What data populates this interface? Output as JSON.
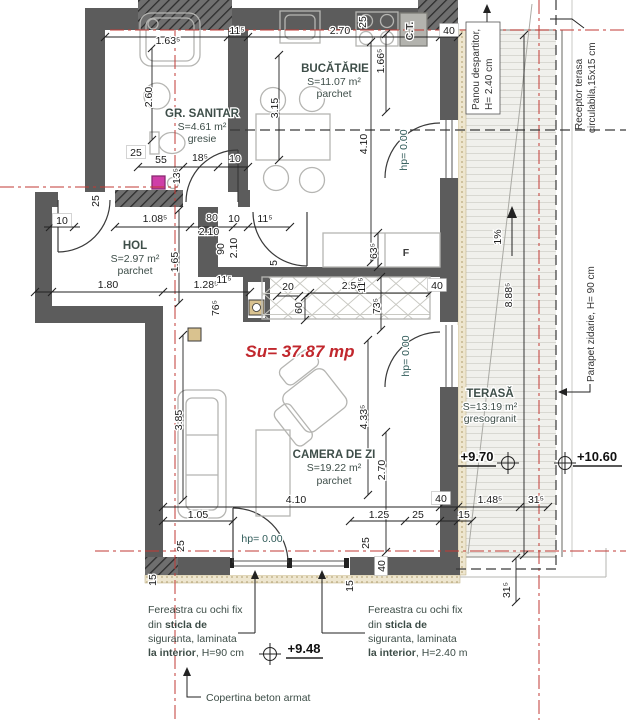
{
  "total_area": "Su= 37.87 mp",
  "rooms": [
    {
      "name": "GR. SANITAR",
      "area": "S=4.61 m²",
      "floor": "gresie"
    },
    {
      "name": "BUCĂTĂRIE",
      "area": "S=11.07 m²",
      "floor": "parchet"
    },
    {
      "name": "HOL",
      "area": "S=2.97 m²",
      "floor": "parchet"
    },
    {
      "name": "CAMERA DE ZI",
      "area": "S=19.22 m²",
      "floor": "parchet"
    },
    {
      "name": "TERASĂ",
      "area": "S=13.19 m²",
      "floor": "gresogranit"
    }
  ],
  "elevations": {
    "terrace": "+9.70",
    "parapet_top": "+10.60",
    "canopy": "+9.48"
  },
  "notes": {
    "panou_l1": "Panou despartitor,",
    "panou_l2": "H= 2.40 cm",
    "receptor_l1": "Receptor terasa",
    "receptor_l2": "circulabila,15x15 cm",
    "parapet": "Parapet zidarie, H= 90 cm",
    "copertina": "Copertina beton armat",
    "window_left": {
      "l1": "Fereastra cu ochi fix",
      "l2a": "din ",
      "l2b": "sticla de",
      "l3": "siguranta, laminata",
      "l4a": "la interior",
      "l4b": ", H=90 cm"
    },
    "window_right": {
      "l1": "Fereastra cu ochi fix",
      "l2a": "din ",
      "l2b": "sticla de",
      "l3": "siguranta, laminata",
      "l4a": "la interior",
      "l4b": ", H=2.40 m"
    }
  },
  "equipment": {
    "boiler": "C.T.",
    "fridge": "F"
  },
  "colors": {
    "axis_red": "#c23a34",
    "wall": "#5c5c5c",
    "room_label": "#3e4e49",
    "area_red": "#c1272d",
    "insulation": "#eee6cf"
  },
  "dims": [
    {
      "t": "1.63⁵",
      "x": 168,
      "y": 44
    },
    {
      "t": "11⁵",
      "x": 237,
      "y": 34
    },
    {
      "t": "2.70",
      "x": 340,
      "y": 34
    },
    {
      "t": "40",
      "x": 449,
      "y": 34,
      "bx": 1
    },
    {
      "t": "25",
      "x": 136,
      "y": 156,
      "bx": 1
    },
    {
      "t": "55",
      "x": 161,
      "y": 163
    },
    {
      "t": "18⁵",
      "x": 200,
      "y": 161
    },
    {
      "t": "10",
      "x": 235,
      "y": 162
    },
    {
      "t": "10",
      "x": 62,
      "y": 224,
      "bx": 1
    },
    {
      "t": "1.08⁵",
      "x": 155,
      "y": 222
    },
    {
      "t": "80",
      "x": 212,
      "y": 221
    },
    {
      "t": "2.10",
      "x": 209,
      "y": 235
    },
    {
      "t": "10",
      "x": 234,
      "y": 222
    },
    {
      "t": "11⁵",
      "x": 265,
      "y": 222
    },
    {
      "t": "1.80",
      "x": 108,
      "y": 288
    },
    {
      "t": "1.28⁵",
      "x": 206,
      "y": 288
    },
    {
      "t": "11⁵",
      "x": 224,
      "y": 283
    },
    {
      "t": "20",
      "x": 288,
      "y": 290
    },
    {
      "t": "2.50",
      "x": 352,
      "y": 289
    },
    {
      "t": "40",
      "x": 437,
      "y": 289,
      "bx": 1
    },
    {
      "t": "4.10",
      "x": 296,
      "y": 503
    },
    {
      "t": "1.05",
      "x": 198,
      "y": 518
    },
    {
      "t": "1.25",
      "x": 379,
      "y": 518
    },
    {
      "t": "25",
      "x": 418,
      "y": 518
    },
    {
      "t": "15",
      "x": 464,
      "y": 518
    },
    {
      "t": "40",
      "x": 441,
      "y": 502,
      "bx": 1
    },
    {
      "t": "1.48⁵",
      "x": 490,
      "y": 503
    },
    {
      "t": "31⁵",
      "x": 536,
      "y": 503
    },
    {
      "t": "2.60",
      "x": 152,
      "y": 97,
      "v": 1
    },
    {
      "t": "13⁵",
      "x": 180,
      "y": 176,
      "v": 1
    },
    {
      "t": "25",
      "x": 99,
      "y": 201,
      "v": 1
    },
    {
      "t": "1.65",
      "x": 178,
      "y": 262,
      "v": 1
    },
    {
      "t": "90",
      "x": 224,
      "y": 249,
      "v": 1
    },
    {
      "t": "2.10",
      "x": 237,
      "y": 248,
      "v": 1
    },
    {
      "t": "76⁵",
      "x": 219,
      "y": 308,
      "v": 1
    },
    {
      "t": "5",
      "x": 277,
      "y": 263,
      "v": 1
    },
    {
      "t": "60",
      "x": 302,
      "y": 308,
      "v": 1
    },
    {
      "t": "3.15",
      "x": 278,
      "y": 108,
      "v": 1
    },
    {
      "t": "4.10",
      "x": 367,
      "y": 144,
      "v": 1
    },
    {
      "t": "1.66⁵",
      "x": 384,
      "y": 61,
      "v": 1
    },
    {
      "t": "25",
      "x": 366,
      "y": 22,
      "v": 1
    },
    {
      "t": "63⁵",
      "x": 377,
      "y": 251,
      "v": 1
    },
    {
      "t": "73⁵",
      "x": 380,
      "y": 306,
      "v": 1
    },
    {
      "t": "11⁵",
      "x": 365,
      "y": 285,
      "v": 1
    },
    {
      "t": "4.33⁵",
      "x": 367,
      "y": 417,
      "v": 1
    },
    {
      "t": "2.70",
      "x": 385,
      "y": 470,
      "v": 1
    },
    {
      "t": "3.85",
      "x": 182,
      "y": 420,
      "v": 1
    },
    {
      "t": "25",
      "x": 369,
      "y": 543,
      "v": 1
    },
    {
      "t": "40",
      "x": 385,
      "y": 566,
      "v": 1,
      "bx": 1
    },
    {
      "t": "15",
      "x": 353,
      "y": 586,
      "v": 1
    },
    {
      "t": "8.88⁵",
      "x": 512,
      "y": 295,
      "v": 1
    },
    {
      "t": "31⁵",
      "x": 510,
      "y": 590,
      "v": 1
    },
    {
      "t": "25",
      "x": 184,
      "y": 546,
      "v": 1
    },
    {
      "t": "15",
      "x": 156,
      "y": 580,
      "v": 1
    },
    {
      "t": "1%",
      "x": 501,
      "y": 237,
      "v": 1
    },
    {
      "t": "hp= 0.00",
      "x": 407,
      "y": 150,
      "v": 1,
      "c": "lvl"
    },
    {
      "t": "hp= 0.00",
      "x": 409,
      "y": 356,
      "v": 1,
      "c": "lvl"
    },
    {
      "t": "hp= 0.00",
      "x": 262,
      "y": 542,
      "c": "lvl"
    },
    {
      "t": "C.T.",
      "x": 413,
      "y": 31,
      "v": 1,
      "c": "eq"
    },
    {
      "t": "F",
      "x": 406,
      "y": 256,
      "c": "eq"
    }
  ]
}
